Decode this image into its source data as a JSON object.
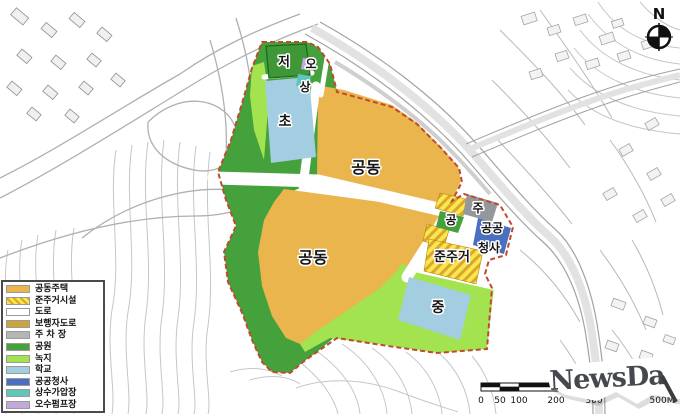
{
  "map": {
    "zones": {
      "jeo": "저",
      "o": "오",
      "sang": "상",
      "cho": "초",
      "gongdong_upper": "공동",
      "gongdong_lower": "공동",
      "junjugeo": "준주거",
      "gong": "공",
      "ju": "주",
      "gonggong": "공공",
      "cheongsa": "청사",
      "jung": "중"
    },
    "colors": {
      "apartment": "#EBB54D",
      "semi_residential_bg": "#F6E94E",
      "semi_residential_stripe": "#DFA32F",
      "road": "#FFFFFF",
      "park": "#44A13C",
      "green_space": "#A2E34F",
      "school": "#A3CEE2",
      "public_office": "#4A6FC0",
      "parking": "#95989B",
      "water_station": "#5FC6BC",
      "sewage_station": "#C3A8DC",
      "boundary": "#C04A2F"
    }
  },
  "legend": {
    "items": [
      {
        "label": "공동주택",
        "color": "#EBB54D"
      },
      {
        "label": "준주거시설",
        "color": "#F6E94E",
        "hatch": true,
        "stripe": "#DFA32F"
      },
      {
        "label": "도로",
        "color": "#FFFFFF"
      },
      {
        "label": "보행자도로",
        "color": "#C9A53B"
      },
      {
        "label": "주 차 장",
        "color": "#B5B5B6"
      },
      {
        "label": "공원",
        "color": "#44A13C"
      },
      {
        "label": "녹지",
        "color": "#A2E34F"
      },
      {
        "label": "학교",
        "color": "#A3CEE2"
      },
      {
        "label": "공공청사",
        "color": "#4A6FC0"
      },
      {
        "label": "상수가압장",
        "color": "#5FC6BC"
      },
      {
        "label": "오수펌프장",
        "color": "#C3A8DC"
      }
    ]
  },
  "compass": {
    "label": "N"
  },
  "scalebar": {
    "labels": [
      "0",
      "50",
      "100",
      "200",
      "300",
      "500M"
    ]
  },
  "watermark": {
    "text": "NewsDa"
  }
}
